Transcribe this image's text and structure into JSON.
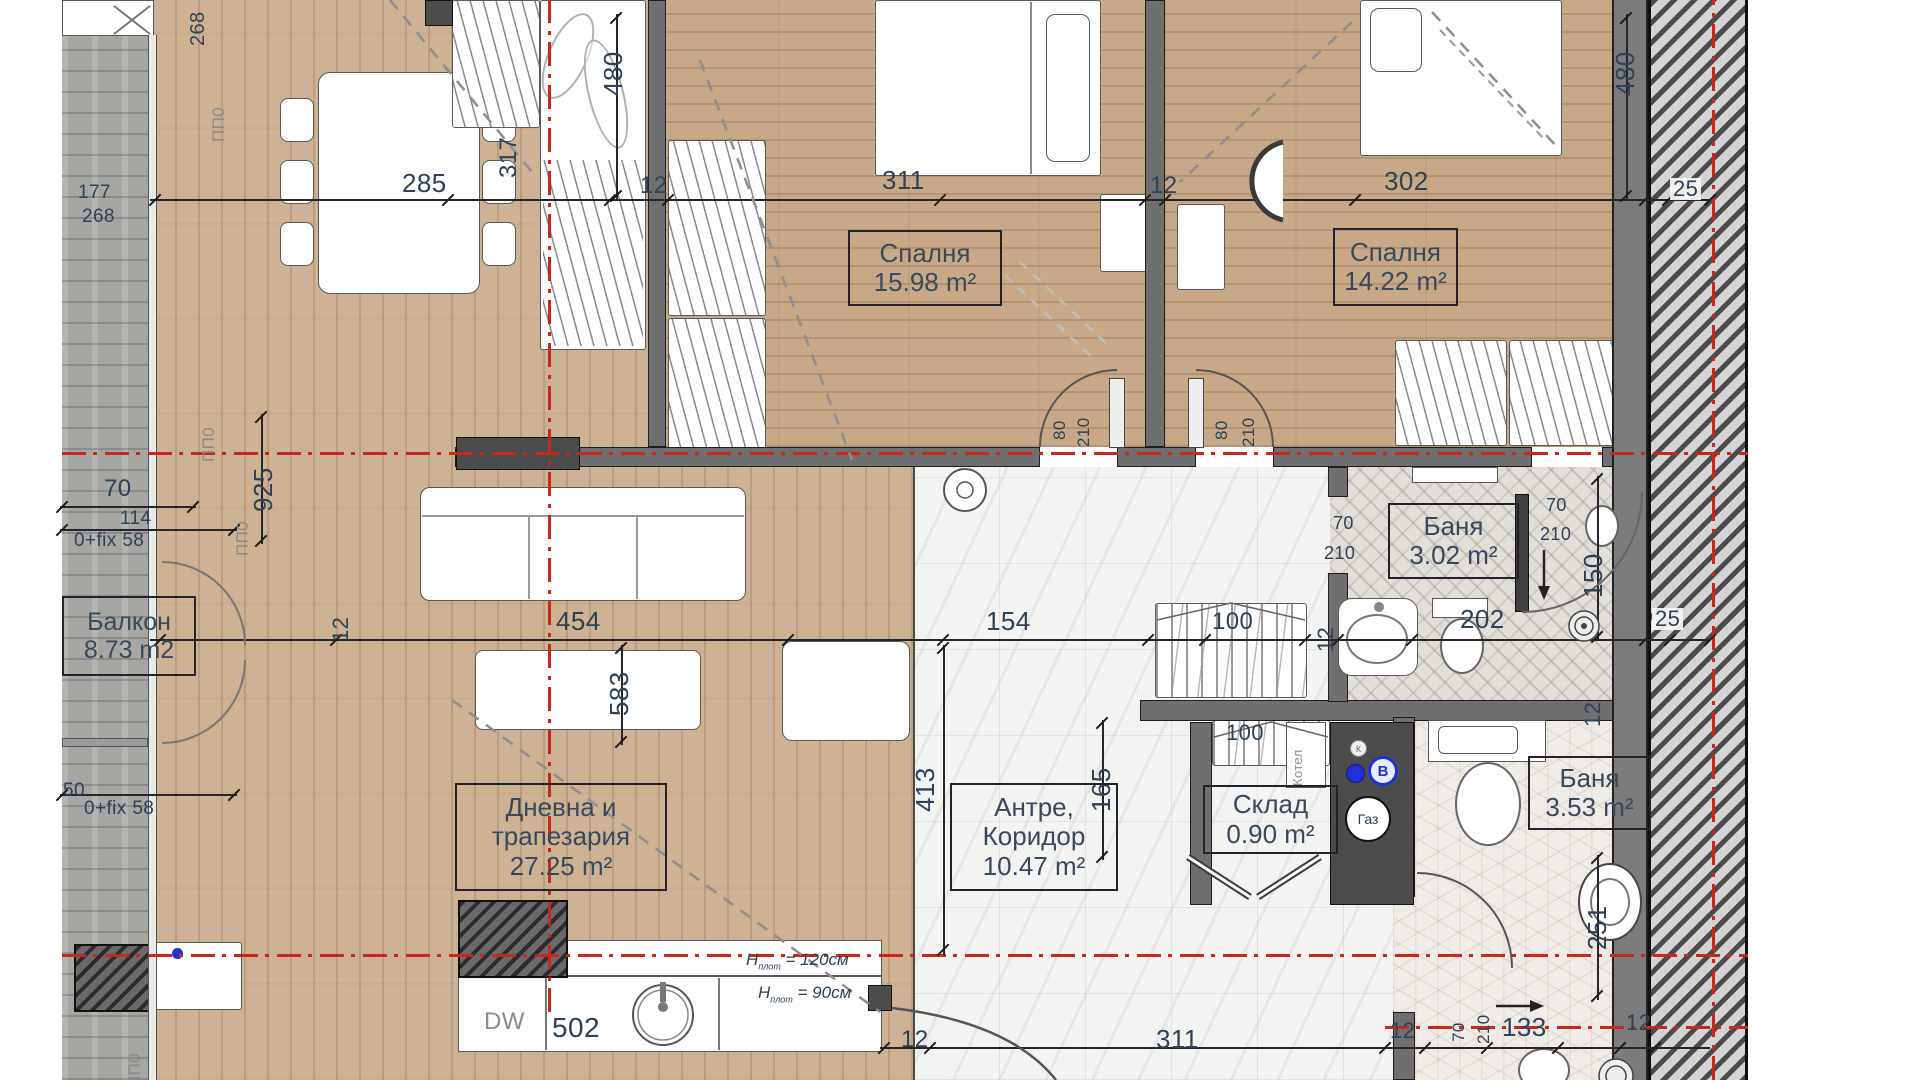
{
  "drawing": {
    "kind": "apartment-floor-plan",
    "language": "bg"
  },
  "rooms": [
    {
      "key": "bedroom-1",
      "lines": [
        "Спалня",
        "15.98 m²"
      ],
      "box": {
        "x": 848,
        "y": 230,
        "w": 150,
        "h": 72
      },
      "fs": 26
    },
    {
      "key": "bedroom-2",
      "lines": [
        "Спалня",
        "14.22 m²"
      ],
      "box": {
        "x": 1333,
        "y": 228,
        "w": 121,
        "h": 74
      },
      "fs": 26
    },
    {
      "key": "living-dining",
      "lines": [
        "Дневна и",
        "трапезария",
        "27.25 m²"
      ],
      "box": {
        "x": 455,
        "y": 783,
        "w": 208,
        "h": 104
      },
      "fs": 26
    },
    {
      "key": "hall-corridor",
      "lines": [
        "Антре,",
        "Коридор",
        "10.47 m²"
      ],
      "box": {
        "x": 950,
        "y": 783,
        "w": 164,
        "h": 104
      },
      "fs": 26
    },
    {
      "key": "bath-1",
      "lines": [
        "Баня",
        "3.02 m²"
      ],
      "box": {
        "x": 1388,
        "y": 503,
        "w": 127,
        "h": 72
      },
      "fs": 26
    },
    {
      "key": "bath-2",
      "lines": [
        "Баня",
        "3.53 m²"
      ],
      "box": {
        "x": 1528,
        "y": 756,
        "w": 119,
        "h": 70
      },
      "fs": 26
    },
    {
      "key": "storage",
      "lines": [
        "Склад",
        "0.90 m²"
      ],
      "box": {
        "x": 1203,
        "y": 785,
        "w": 131,
        "h": 65
      },
      "fs": 26
    },
    {
      "key": "balcony",
      "lines": [
        "Балкон",
        "8.73 m2"
      ],
      "box": {
        "x": 62,
        "y": 596,
        "w": 130,
        "h": 76
      },
      "fs": 25
    }
  ],
  "labels": [
    {
      "t": "268",
      "x": 188,
      "y": 46,
      "s": 20,
      "r": 1
    },
    {
      "t": "177",
      "x": 78,
      "y": 183,
      "s": 19
    },
    {
      "t": "268",
      "x": 82,
      "y": 207,
      "s": 19
    },
    {
      "t": "285",
      "x": 402,
      "y": 170,
      "s": 26
    },
    {
      "t": "12",
      "x": 640,
      "y": 174,
      "s": 24
    },
    {
      "t": "317",
      "x": 497,
      "y": 178,
      "s": 24,
      "r": 1
    },
    {
      "t": "480",
      "x": 600,
      "y": 96,
      "s": 26,
      "r": 1
    },
    {
      "t": "311",
      "x": 882,
      "y": 167,
      "s": 26
    },
    {
      "t": "12",
      "x": 1150,
      "y": 174,
      "s": 24
    },
    {
      "t": "302",
      "x": 1384,
      "y": 168,
      "s": 26
    },
    {
      "t": "480",
      "x": 1612,
      "y": 96,
      "s": 26,
      "r": 1
    },
    {
      "t": "25",
      "x": 1670,
      "y": 178,
      "s": 22,
      "c": "chip"
    },
    {
      "t": "70",
      "x": 104,
      "y": 477,
      "s": 24
    },
    {
      "t": "114",
      "x": 120,
      "y": 509,
      "s": 19
    },
    {
      "t": "0+fix 58",
      "x": 74,
      "y": 531,
      "s": 19
    },
    {
      "t": "925",
      "x": 250,
      "y": 512,
      "s": 26,
      "r": 1
    },
    {
      "t": "ПП0",
      "x": 210,
      "y": 142,
      "s": 17,
      "r": 1,
      "c": "muted"
    },
    {
      "t": "ПП0",
      "x": 200,
      "y": 462,
      "s": 17,
      "r": 1,
      "c": "muted"
    },
    {
      "t": "ПП0",
      "x": 234,
      "y": 556,
      "s": 17,
      "r": 1,
      "c": "muted"
    },
    {
      "t": "50",
      "x": 63,
      "y": 781,
      "s": 19
    },
    {
      "t": "0+fix 58",
      "x": 84,
      "y": 799,
      "s": 19
    },
    {
      "t": "454",
      "x": 556,
      "y": 608,
      "s": 26
    },
    {
      "t": "12",
      "x": 330,
      "y": 642,
      "s": 22,
      "r": 1
    },
    {
      "t": "154",
      "x": 986,
      "y": 608,
      "s": 26
    },
    {
      "t": "100",
      "x": 1212,
      "y": 610,
      "s": 24
    },
    {
      "t": "12",
      "x": 1315,
      "y": 652,
      "s": 22,
      "r": 1
    },
    {
      "t": "202",
      "x": 1460,
      "y": 606,
      "s": 26
    },
    {
      "t": "25",
      "x": 1652,
      "y": 608,
      "s": 22,
      "c": "chip"
    },
    {
      "t": "80",
      "x": 1051,
      "y": 440,
      "s": 17,
      "r": 1
    },
    {
      "t": "210",
      "x": 1075,
      "y": 447,
      "s": 17,
      "r": 1
    },
    {
      "t": "80",
      "x": 1213,
      "y": 440,
      "s": 17,
      "r": 1
    },
    {
      "t": "210",
      "x": 1240,
      "y": 447,
      "s": 17,
      "r": 1
    },
    {
      "t": "70",
      "x": 1333,
      "y": 514,
      "s": 18
    },
    {
      "t": "210",
      "x": 1324,
      "y": 544,
      "s": 18
    },
    {
      "t": "70",
      "x": 1546,
      "y": 496,
      "s": 18
    },
    {
      "t": "210",
      "x": 1540,
      "y": 525,
      "s": 18
    },
    {
      "t": "150",
      "x": 1580,
      "y": 598,
      "s": 26,
      "r": 1
    },
    {
      "t": "583",
      "x": 606,
      "y": 716,
      "s": 26,
      "r": 1
    },
    {
      "t": "413",
      "x": 912,
      "y": 812,
      "s": 26,
      "r": 1
    },
    {
      "t": "165",
      "x": 1088,
      "y": 812,
      "s": 26,
      "r": 1
    },
    {
      "t": "100",
      "x": 1226,
      "y": 722,
      "s": 22
    },
    {
      "t": "12",
      "x": 1582,
      "y": 727,
      "s": 22,
      "r": 1
    },
    {
      "t": "251",
      "x": 1584,
      "y": 950,
      "s": 26,
      "r": 1
    },
    {
      "t": "DW",
      "x": 484,
      "y": 1010,
      "s": 24,
      "c": "muted"
    },
    {
      "t": "502",
      "x": 552,
      "y": 1014,
      "s": 28
    },
    {
      "t": "12",
      "x": 901,
      "y": 1028,
      "s": 24
    },
    {
      "t": "311",
      "x": 1156,
      "y": 1026,
      "s": 26
    },
    {
      "t": "12",
      "x": 1390,
      "y": 1020,
      "s": 22
    },
    {
      "t": "70",
      "x": 1450,
      "y": 1042,
      "s": 17,
      "r": 1
    },
    {
      "t": "210",
      "x": 1475,
      "y": 1044,
      "s": 17,
      "r": 1
    },
    {
      "t": "133",
      "x": 1502,
      "y": 1014,
      "s": 26
    },
    {
      "t": "12",
      "x": 1626,
      "y": 1012,
      "s": 22
    },
    {
      "t": "ПП0",
      "x": 126,
      "y": 1088,
      "s": 17,
      "r": 1,
      "c": "muted"
    },
    {
      "t": "Котел",
      "x": 1291,
      "y": 786,
      "s": 13,
      "r": 1,
      "c": "muted"
    }
  ],
  "notes": [
    {
      "base": "H",
      "sub": "плот",
      "eq": "= 120см",
      "x": 746,
      "y": 950
    },
    {
      "base": "H",
      "sub": "плот",
      "eq": "= 90см",
      "x": 758,
      "y": 983
    }
  ],
  "equipment": {
    "gas": "Газ",
    "water_valve": "В",
    "k_valve": "К"
  },
  "colors": {
    "axis_red": "#c6291c",
    "dim_text": "#2e4156",
    "wall_gray": "#6f6f6f",
    "wood": "#cdb293",
    "marble": "#f3f3f2"
  }
}
